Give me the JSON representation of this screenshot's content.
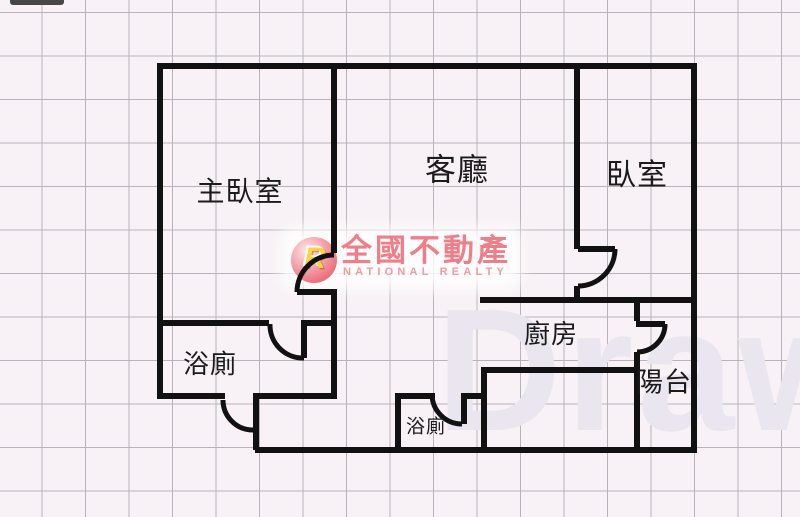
{
  "canvas": {
    "background": "#f8f1f5",
    "grid_color": "#b9b2bd",
    "wall_color": "#111111"
  },
  "rooms": [
    {
      "id": "master-bedroom",
      "label": "主臥室"
    },
    {
      "id": "living-room",
      "label": "客廳"
    },
    {
      "id": "bedroom",
      "label": "臥室"
    },
    {
      "id": "bathroom-main",
      "label": "浴廁"
    },
    {
      "id": "kitchen",
      "label": "廚房"
    },
    {
      "id": "bathroom-small",
      "label": "浴廁"
    },
    {
      "id": "balcony",
      "label": "陽台"
    }
  ],
  "logo": {
    "monogram": "R",
    "brand": "全國不動產",
    "tagline": "NATIONAL REALTY",
    "brand_color": "#ee7f88",
    "tagline_color": "#f29ba1",
    "monogram_color": "#ffd23e",
    "circle_color": "#ec7380"
  },
  "watermark": {
    "text": "Draw",
    "color": "#e9e6ef"
  }
}
